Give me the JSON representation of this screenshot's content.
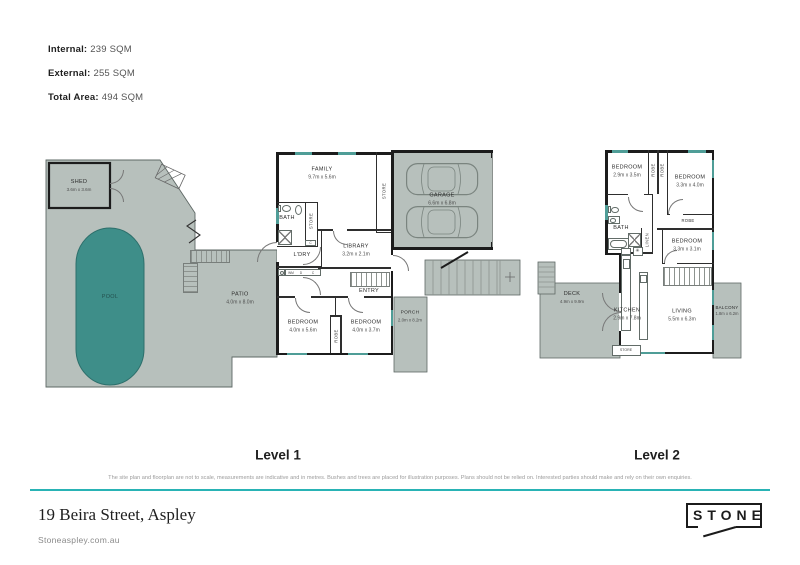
{
  "summary": {
    "internal_label": "Internal:",
    "internal_value": "239 SQM",
    "external_label": "External:",
    "external_value": "255 SQM",
    "total_label": "Total Area:",
    "total_value": "494 SQM"
  },
  "level1": {
    "title": "Level 1",
    "rooms": {
      "shed": {
        "name": "SHED",
        "dims": "3.6m x 3.6m"
      },
      "pool": {
        "name": "POOL"
      },
      "patio": {
        "name": "PATIO",
        "dims": "4.0m x 8.0m"
      },
      "family": {
        "name": "FAMILY",
        "dims": "9.7m x 5.6m"
      },
      "bath": {
        "name": "BATH"
      },
      "store_upper": {
        "name": "STORE"
      },
      "store_right": {
        "name": "STORE"
      },
      "ldry": {
        "name": "L'DRY"
      },
      "library": {
        "name": "LIBRARY",
        "dims": "3.2m x 2.1m"
      },
      "entry": {
        "name": "ENTRY"
      },
      "bedroom_left": {
        "name": "BEDROOM",
        "dims": "4.0m x 5.6m"
      },
      "bedroom_right": {
        "name": "BEDROOM",
        "dims": "4.0m x 3.7m"
      },
      "robe": {
        "name": "ROBE"
      },
      "garage": {
        "name": "GARAGE",
        "dims": "6.6m x 6.8m"
      },
      "porch": {
        "name": "PORCH",
        "dims": "2.0m x 8.2m"
      },
      "wm": "WM",
      "d": "D",
      "c": "C",
      "c2": "C"
    }
  },
  "level2": {
    "title": "Level 2",
    "rooms": {
      "bedroom_left": {
        "name": "BEDROOM",
        "dims": "2.9m x 3.5m"
      },
      "bedroom_top_right": {
        "name": "BEDROOM",
        "dims": "3.3m x 4.0m"
      },
      "bedroom_mid_right": {
        "name": "BEDROOM",
        "dims": "3.3m x 3.1m"
      },
      "robe1": {
        "name": "ROBE"
      },
      "robe2": {
        "name": "ROBE"
      },
      "robe3": {
        "name": "ROBE"
      },
      "bath": {
        "name": "BATH"
      },
      "linen": {
        "name": "LINEN"
      },
      "kitchen": {
        "name": "KITCHEN",
        "dims": "2.9m x 7.8m"
      },
      "living": {
        "name": "LIVING",
        "dims": "5.5m x 6.3m"
      },
      "deck": {
        "name": "DECK",
        "dims": "4.9m x 9.9m"
      },
      "balcony": {
        "name": "BALCONY",
        "dims": "1.8m x 6.2m"
      },
      "store": {
        "name": "STORE"
      },
      "cooktop_symbol": "✳"
    }
  },
  "footer": {
    "disclaimer": "The site plan and floorplan are not to scale, measurements are indicative and in metres. Bushes and trees are placed for illustration purposes. Plans should not be relied on. Interested parties should make and rely on their own enquiries.",
    "address": "19 Beira Street, Aspley",
    "website": "Stoneaspley.com.au",
    "brand": "STONE"
  },
  "colors": {
    "external_area": "#b7c0bc",
    "pool": "#3e8e89",
    "wall": "#1c1c1c",
    "window": "#4f9d97",
    "divider_line": "#29b3b5"
  }
}
